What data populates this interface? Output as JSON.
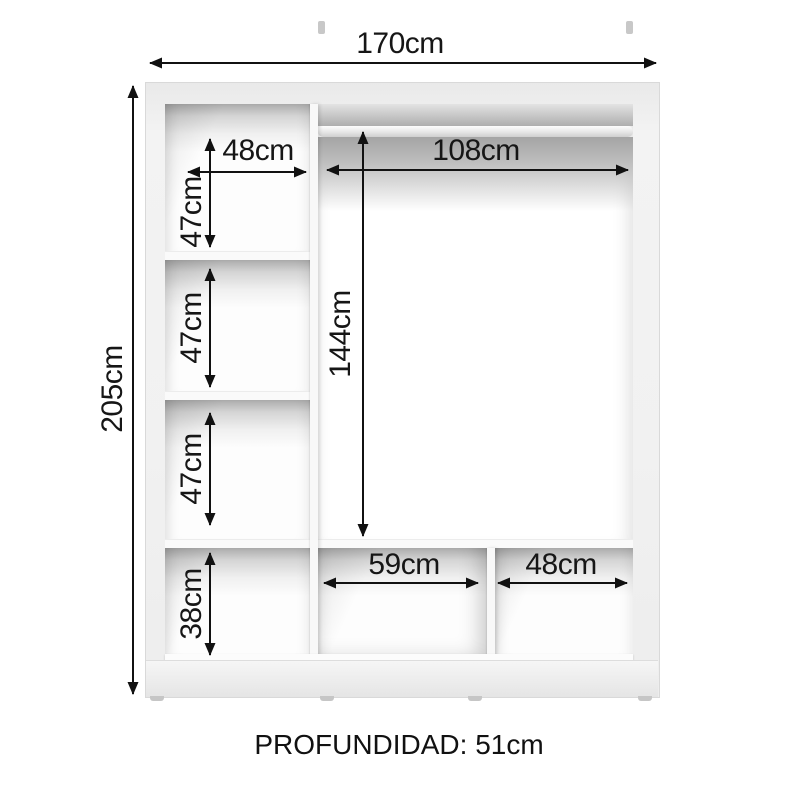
{
  "diagram": {
    "type": "wardrobe-dimension-diagram",
    "depth_label": "PROFUNDIDAD: 51cm",
    "unit": "cm"
  },
  "dimensions": {
    "total_width": "170cm",
    "total_height": "205cm",
    "top_left_shelf_width": "48cm",
    "left_compartment_1_height": "47cm",
    "left_compartment_2_height": "47cm",
    "left_compartment_3_height": "47cm",
    "bottom_left_compartment_height": "38cm",
    "hanging_rod_width": "108cm",
    "hanging_space_height": "144cm",
    "bottom_middle_compartment_width": "59cm",
    "bottom_right_compartment_width": "48cm"
  },
  "colors": {
    "background": "#ffffff",
    "panel": "#f1f1f1",
    "panel_edge": "#d9d9d9",
    "interior_shadow": "#a8a8a8",
    "arrow": "#111111",
    "text": "#161616"
  }
}
